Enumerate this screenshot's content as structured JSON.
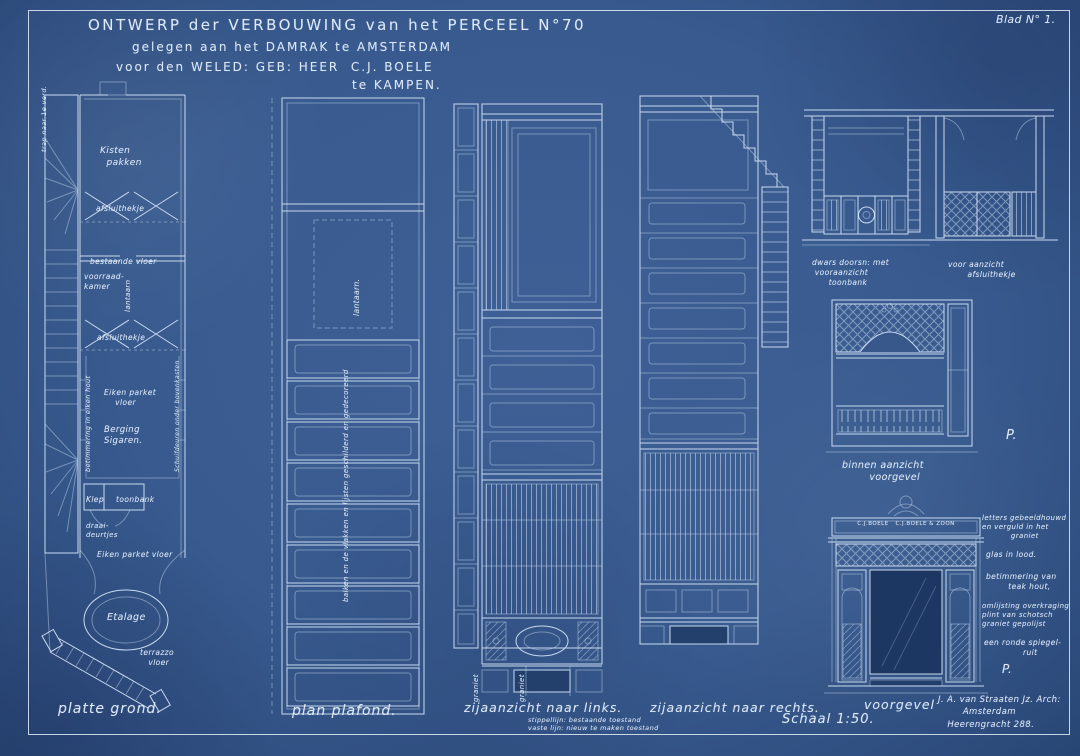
{
  "sheet": {
    "blad": "Blad N° 1.",
    "title_line1": "ONTWERP der VERBOUWING van het PERCEEL N°70",
    "title_line2": "gelegen aan het DAMRAK te AMSTERDAM",
    "title_line3": "voor den WELED: GEB: HEER  C.J. BOELE",
    "title_line4": "te KAMPEN.",
    "scale": "Schaal 1:50.",
    "architect": "J. A. van Straaten Jz. Arch:\n        Amsterdam\n   Heerengracht 288."
  },
  "colors": {
    "paper": "#38588c",
    "line": "#c8daf0",
    "text": "#dde9f8"
  },
  "floor_plan": {
    "caption": "platte grond.",
    "labels": {
      "trap": "trap naar 1e verd.",
      "kisten": "Kisten\n  pakken",
      "hekje1": "afsluithekje",
      "lantaarn": "lantaarn",
      "bestaande_vloer": "bestaande vloer",
      "voorraad": "voorraad-\nkamer",
      "hekje2": "afsluithekje",
      "betimmering": "betimmering in eiken hout",
      "parket1": "Eiken parket\n    vloer",
      "berging": "Berging\nSigaren.",
      "schuifdeuren": "Schuifdeuren onder bovenkasten",
      "klep": "Klep",
      "toonbank": "toonbank",
      "draaideurtjes": "draai-\ndeurtjes",
      "parket2": "Eiken parket vloer",
      "etalage": "Etalage",
      "terrazzo": "terrazzo\n   vloer"
    }
  },
  "ceiling_plan": {
    "caption": "plan plafond.",
    "labels": {
      "lantaarn": "lantaarn.",
      "balken": "balken en de vlakken en lijsten geschilderd en gedecoreerd"
    }
  },
  "left_view": {
    "caption": "zijaanzicht naar links.",
    "note": "stippellijn: bestaande toestand\nvaste lijn: nieuw te maken toestand",
    "labels": {
      "graniet1": "graniet",
      "graniet2": "graniet"
    }
  },
  "right_view": {
    "caption": "zijaanzicht naar rechts."
  },
  "counter_detail": {
    "caption": "dwars doorsn: met\n vooraanzicht\n      toonbank"
  },
  "gate_detail": {
    "caption": "voor aanzicht\n       afsluithekje"
  },
  "inner_front": {
    "caption": "binnen aanzicht\n        voorgevel",
    "p": "P."
  },
  "storefront": {
    "caption": "voorgevel",
    "sign": "C.J.BOELE   C.J.BOELE & ZOON",
    "p": "P.",
    "notes": {
      "n1": "letters gebeeldhouwd\nen verguld in het\n           graniet",
      "n2": "glas in lood.",
      "n3": "betimmering van\n        teak hout,",
      "n4": "omlijsting overkraging\nplint van schotsch\ngraniet gepolijst",
      "n5": "een ronde spiegel-\n              ruit"
    }
  }
}
